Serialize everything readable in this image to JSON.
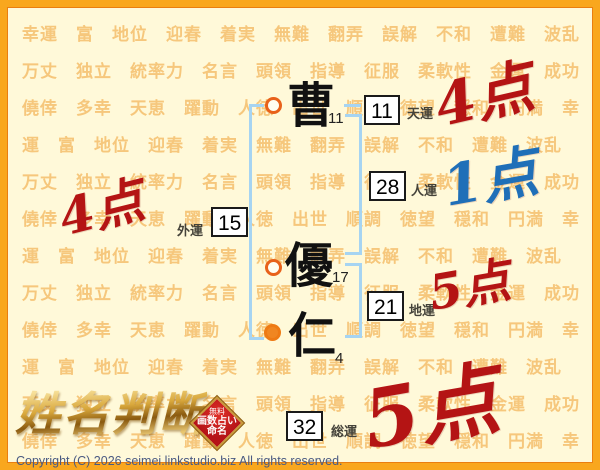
{
  "page": {
    "logo_text": "姓名判断",
    "badge": {
      "line1": "無料",
      "line2": "画数占い",
      "line3": "命名"
    },
    "copyright": "Copyright (C) 2026 seimei.linkstudio.biz All rights reserved."
  },
  "name": {
    "characters": [
      {
        "char": "曹",
        "strokes": "11",
        "marker": "open"
      },
      {
        "char": "優",
        "strokes": "17",
        "marker": "open"
      },
      {
        "char": "仁",
        "strokes": "4",
        "marker": "filled"
      }
    ]
  },
  "fortunes": [
    {
      "id": "ten",
      "label": "天運",
      "value": "11",
      "score": "4点",
      "score_color": "#B41414"
    },
    {
      "id": "jin",
      "label": "人運",
      "value": "28",
      "score": "1点",
      "score_color": "#1F6FB8"
    },
    {
      "id": "gai",
      "label": "外運",
      "value": "15",
      "score": "4点",
      "score_color": "#B41414"
    },
    {
      "id": "chi",
      "label": "地運",
      "value": "21",
      "score": "5点",
      "score_color": "#B41414"
    },
    {
      "id": "sou",
      "label": "総運",
      "value": "32",
      "score": "5点",
      "score_color": "#B41414"
    }
  ],
  "background": {
    "words": [
      "幸運",
      "富",
      "地位",
      "迎春",
      "着実",
      "無難",
      "翻弄",
      "誤解",
      "不和",
      "遭難",
      "波乱",
      "万丈",
      "独立",
      "統率力",
      "名言",
      "頭領",
      "指導",
      "征服",
      "柔軟性",
      "金運",
      "成功",
      "僥倖",
      "多幸",
      "天恵",
      "躍動",
      "人徳",
      "出世",
      "順調",
      "徳望",
      "穏和",
      "円満"
    ]
  },
  "colors": {
    "background": "#FFF9D9",
    "pattern_text": "#F6C77C",
    "frame": "#F9A71E",
    "bracket": "#A6D4F2",
    "marker_ring": "#E8611A",
    "score_red": "#B41414",
    "score_blue": "#1F6FB8",
    "badge_red": "#B51318",
    "logo_gold": "#D9A83C"
  }
}
